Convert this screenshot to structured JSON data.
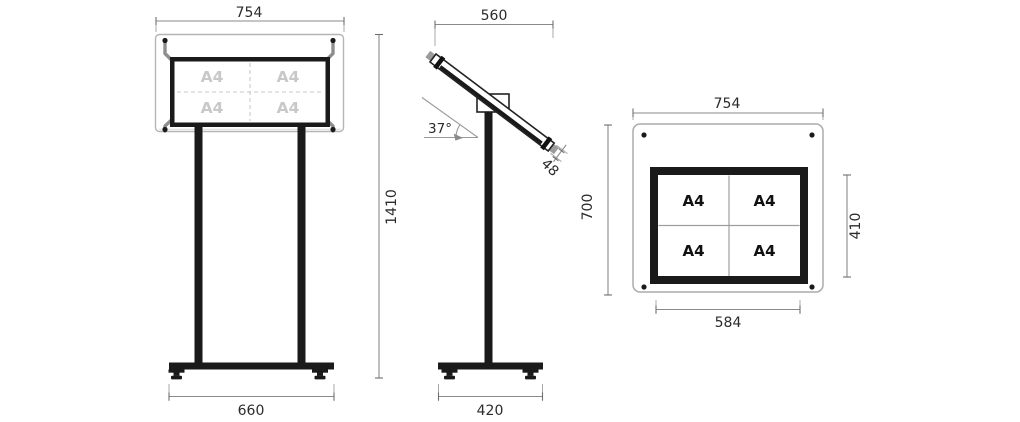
{
  "title": "Display stand technical drawing",
  "colors": {
    "ink": "#1a1a1a",
    "dim_line": "#8a8a8a",
    "dim_text": "#2b2b2b",
    "ghost_text": "#c8c8c8",
    "bracket": "#8e8e8e",
    "glass_edge": "#b5b5b5"
  },
  "front": {
    "width": "754",
    "height": "1410",
    "base": "660",
    "a4": [
      "A4",
      "A4",
      "A4",
      "A4"
    ]
  },
  "side": {
    "width": "560",
    "angle": "37°",
    "thickness": "48",
    "base": "420"
  },
  "face": {
    "width": "754",
    "height": "700",
    "inner_height": "410",
    "inner_width": "584",
    "a4": [
      "A4",
      "A4",
      "A4",
      "A4"
    ]
  }
}
